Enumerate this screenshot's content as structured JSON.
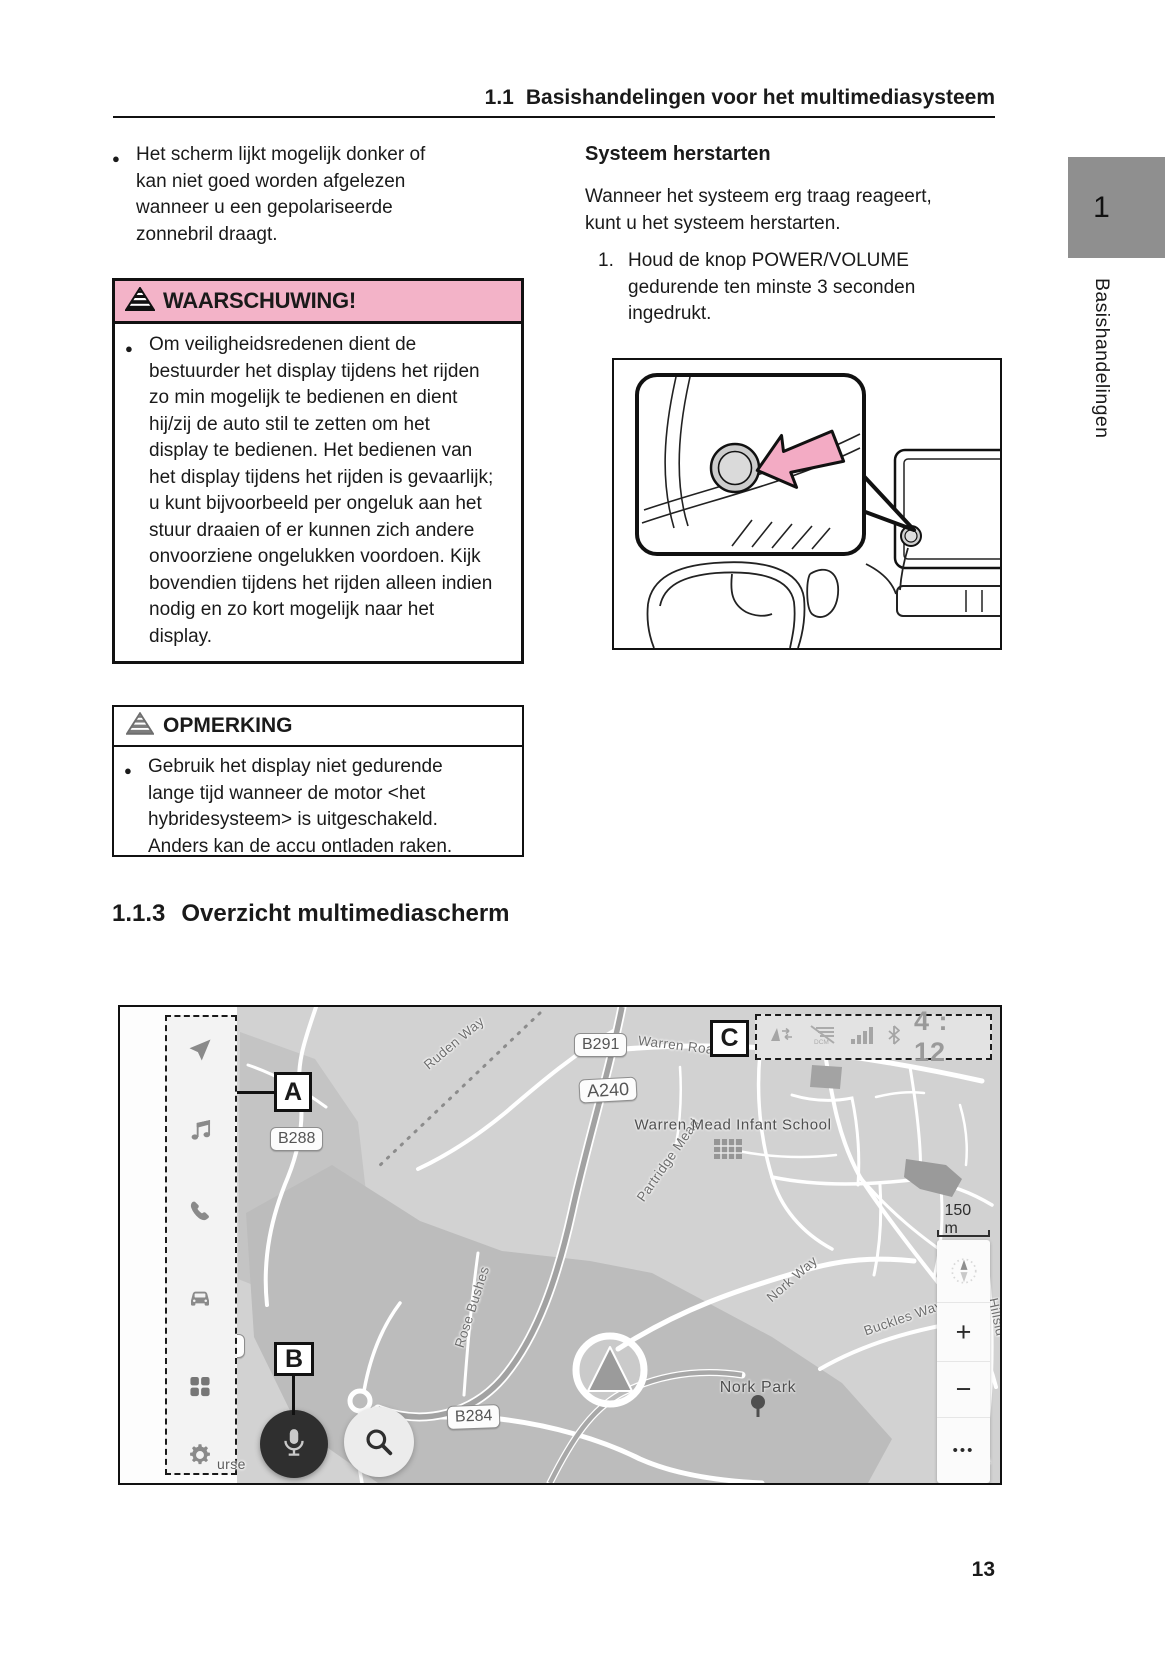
{
  "header": {
    "number": "1.1",
    "title": "Basishandelingen voor het multimediasysteem"
  },
  "side_tab": {
    "chapter": "1",
    "label": "Basishandelingen"
  },
  "page_number": "13",
  "left_column": {
    "bullet": "Het scherm lijkt mogelijk donker of kan niet goed worden afgelezen wanneer u een gepolariseerde zonnebril draagt."
  },
  "warning_box": {
    "title": "WAARSCHUWING!",
    "icon": "striped-pyramid-warning-icon",
    "bullet": "Om veiligheidsredenen dient de bestuurder het display tijdens het rijden zo min mogelijk te bedienen en dient hij/zij de auto stil te zetten om het display te bedienen. Het bedienen van het display tijdens het rijden is gevaarlijk; u kunt bijvoorbeeld per ongeluk aan het stuur draaien of er kunnen zich andere onvoorziene ongelukken voordoen. Kijk bovendien tijdens het rijden alleen indien nodig en zo kort mogelijk naar het display."
  },
  "note_box": {
    "title": "OPMERKING",
    "icon": "striped-pyramid-note-icon",
    "bullet": "Gebruik het display niet gedurende lange tijd wanneer de motor <het hybridesysteem> is uitgeschakeld. Anders kan de accu ontladen raken."
  },
  "right_column": {
    "heading": "Systeem herstarten",
    "paragraph": "Wanneer het systeem erg traag reageert, kunt u het systeem herstarten.",
    "step_number": "1.",
    "step_text": "Houd de knop POWER/VOLUME gedurende ten minste 3 seconden ingedrukt.",
    "illustration": "dashboard-power-volume-knob-callout-drawing"
  },
  "section_heading": {
    "number": "1.1.3",
    "title": "Overzicht multimediascherm"
  },
  "map": {
    "markers": {
      "a": "A",
      "b": "B",
      "c": "C"
    },
    "status_bar": {
      "icons": [
        "gps-arrows-icon",
        "dcm-offline-icon",
        "signal-bars-icon",
        "bluetooth-icon"
      ],
      "clock": "4 : 12"
    },
    "sidebar_icons": [
      "navigation-arrow-icon",
      "music-note-icon",
      "phone-icon",
      "car-icon",
      "app-grid-icon",
      "settings-gear-icon"
    ],
    "road_labels": [
      {
        "text": "B291"
      },
      {
        "text": "A240"
      },
      {
        "text": "B288"
      },
      {
        "text": "B284"
      },
      {
        "text": "4"
      }
    ],
    "street_names": [
      {
        "text": "Ruden Way"
      },
      {
        "text": "Warren Roa"
      },
      {
        "text": "Partridge Mead"
      },
      {
        "text": "Rose Bushes"
      },
      {
        "text": "Nork Way"
      },
      {
        "text": "Buckles Way"
      },
      {
        "text": "Hillsid"
      },
      {
        "text": "urse"
      },
      {
        "text": "Driv"
      }
    ],
    "places": [
      {
        "text": "Warren Mead Infant School"
      },
      {
        "text": "Nork Park"
      }
    ],
    "scale": "150 m",
    "controls": {
      "compass": "compass-icon",
      "zoom_in": "+",
      "zoom_out": "−",
      "more": "•••"
    },
    "buttons": {
      "mic": "microphone-icon",
      "search": "magnifier-icon"
    }
  },
  "colors": {
    "warning_pink": "#F3B3C8",
    "arrow_pink": "#F3ABC4",
    "tab_gray": "#8F8F8F",
    "map_background": "#D2D2D2",
    "dark_button": "#2F2F2F"
  }
}
